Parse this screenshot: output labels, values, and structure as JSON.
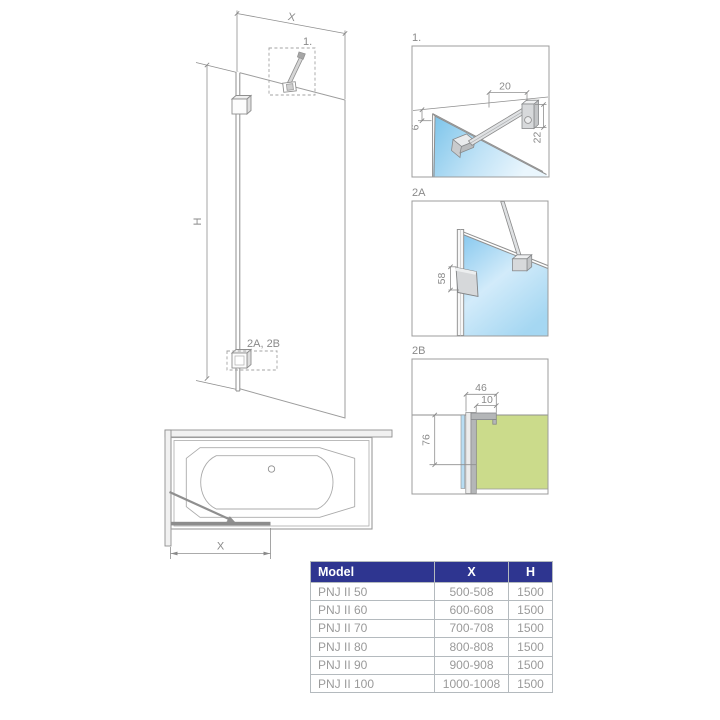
{
  "colors": {
    "line": "#8f8f8f",
    "text": "#8a8a8a",
    "glass-blue": "#7cc4ea",
    "glass-blue-light": "#eaf6fd",
    "tub-green": "#cbdb8b",
    "table-header-bg": "#2e3590",
    "table-header-text": "#ffffff",
    "table-text": "#9a9a9a",
    "table-border": "#b4babe",
    "table-border-outer": "#98a0a5"
  },
  "main_view": {
    "width_dim_label": "X",
    "height_dim_label": "H",
    "detail_ref_top": "1.",
    "detail_ref_bottom": "2A, 2B"
  },
  "tub_view": {
    "width_dim_label": "X"
  },
  "detail_1": {
    "label": "1.",
    "dim_width": "20",
    "dim_height": "22",
    "dim_glass": "6"
  },
  "detail_2a": {
    "label": "2A",
    "dim_handle": "58"
  },
  "detail_2b": {
    "label": "2B",
    "dim_total": "46",
    "dim_offset": "10",
    "dim_drop": "76"
  },
  "table": {
    "headers": [
      "Model",
      "X",
      "H"
    ],
    "rows": [
      [
        "PNJ II 50",
        "500-508",
        "1500"
      ],
      [
        "PNJ II 60",
        "600-608",
        "1500"
      ],
      [
        "PNJ II 70",
        "700-708",
        "1500"
      ],
      [
        "PNJ II 80",
        "800-808",
        "1500"
      ],
      [
        "PNJ II 90",
        "900-908",
        "1500"
      ],
      [
        "PNJ II 100",
        "1000-1008",
        "1500"
      ]
    ]
  }
}
